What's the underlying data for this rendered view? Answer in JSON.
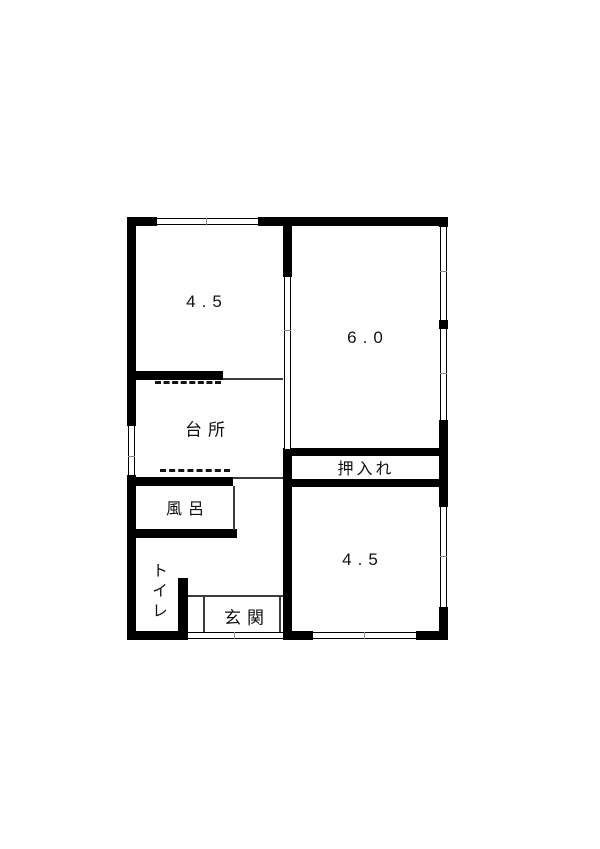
{
  "diagram": {
    "type": "japanese-apartment-floor-plan",
    "background_color": "#ffffff",
    "wall_color": "#000000",
    "rooms": [
      {
        "name": "tatami-room-top-left",
        "label": "4.5"
      },
      {
        "name": "tatami-room-top-right",
        "label": "6.0"
      },
      {
        "name": "kitchen",
        "label": "台所"
      },
      {
        "name": "closet",
        "label": "押入れ"
      },
      {
        "name": "bath",
        "label": "風呂"
      },
      {
        "name": "toilet",
        "label": "トイレ"
      },
      {
        "name": "entrance",
        "label": "玄関"
      },
      {
        "name": "tatami-room-bottom-right",
        "label": "4.5"
      }
    ]
  }
}
